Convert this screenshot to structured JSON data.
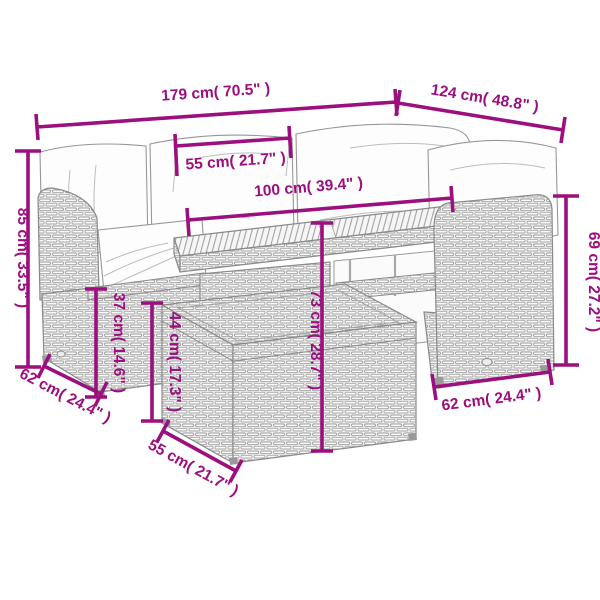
{
  "diagram": {
    "type": "product-dimension-diagram",
    "subject": "5-piece poly rattan garden lounge set with slatted-top table and footstool",
    "background_color": "#ffffff",
    "dimension_color": "#9C0F7E",
    "line_art_color": "#8a8a8a",
    "unit_primary": "cm",
    "unit_secondary": "inch"
  },
  "dims": {
    "sofa_total_width": {
      "label": "179 cm( 70.5\" )",
      "cm": 179,
      "inch": 70.5
    },
    "sofa_total_depth": {
      "label": "124 cm( 48.8\" )",
      "cm": 124,
      "inch": 48.8
    },
    "seat_cushion_width": {
      "label": "55 cm( 21.7\" )",
      "cm": 55,
      "inch": 21.7
    },
    "table_length": {
      "label": "100 cm( 39.4\" )",
      "cm": 100,
      "inch": 39.4
    },
    "back_height": {
      "label": "85 cm( 33.5\" )",
      "cm": 85,
      "inch": 33.5
    },
    "seat_height": {
      "label": "37 cm( 14.6\" )",
      "cm": 37,
      "inch": 14.6
    },
    "stool_height": {
      "label": "44 cm( 17.3\" )",
      "cm": 44,
      "inch": 17.3
    },
    "table_height": {
      "label": "73 cm( 28.7\" )",
      "cm": 73,
      "inch": 28.7
    },
    "arm_height": {
      "label": "69 cm( 27.2\" )",
      "cm": 69,
      "inch": 27.2
    },
    "left_module_depth": {
      "label": "62 cm( 24.4\" )",
      "cm": 62,
      "inch": 24.4
    },
    "right_module_depth": {
      "label": "62 cm( 24.4\" )",
      "cm": 62,
      "inch": 24.4
    },
    "stool_width": {
      "label": "55 cm( 21.7\" )",
      "cm": 55,
      "inch": 21.7
    }
  }
}
